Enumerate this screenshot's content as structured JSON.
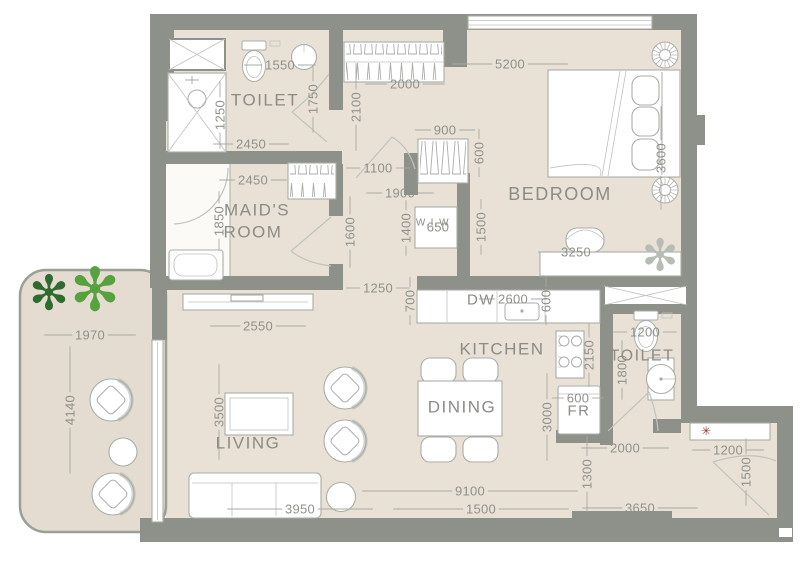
{
  "title": "apartment-floor-plan",
  "rooms": {
    "toilet_top": "TOILET",
    "maids_line1": "MAID'S",
    "maids_line2": "ROOM",
    "wiw": "W.I.W",
    "bedroom": "BEDROOM",
    "kitchen": "KITCHEN",
    "dining": "DINING",
    "living": "LIVING",
    "toilet_entry": "TOILET",
    "dishwasher": "DW",
    "fridge": "FR"
  },
  "dimensions_mm": {
    "d1550": "1550",
    "d2000_closet": "2000",
    "d5200": "5200",
    "d900": "900",
    "d2450_toilet": "2450",
    "d2450_maids": "2450",
    "d1100": "1100",
    "d1900": "1900",
    "d650": "650",
    "d3250": "3250",
    "d1250_hall": "1250",
    "d2600": "2600",
    "d2550": "2550",
    "d1970": "1970",
    "d1200_toilet": "1200",
    "d600_fridge": "600",
    "d2000_entry": "2000",
    "d1200_entry": "1200",
    "d3950": "3950",
    "d9100": "9100",
    "d1500_overall": "1500",
    "d3650": "3650",
    "d1250_shower": "1250",
    "d1750": "1750",
    "d2100": "2100",
    "d600_wardrobe": "600",
    "d3600": "3600",
    "d1850": "1850",
    "d1600": "1600",
    "d1400": "1400",
    "d1500_wiw": "1500",
    "d700": "700",
    "d600_kitchen": "600",
    "d2150": "2150",
    "d1800": "1800",
    "d3000": "3000",
    "d1300": "1300",
    "d1500_entry": "1500",
    "d4140": "4140",
    "d3500": "3500"
  },
  "icons": {
    "plant": "✻",
    "sprinkler": "✳"
  },
  "colors": {
    "wall": "#8d9189",
    "floor": "#e9e1d6",
    "balcony_floor": "#e4dcd0",
    "balcony_edge": "#9aa096",
    "fixture_white": "#ffffff",
    "stroke": "#a9ada7",
    "stroke_light": "#bfc3bc",
    "text": "#8a8c85",
    "dim_text": "#8f918b",
    "dim_line": "#a8aaa3",
    "plant_dark": "#2f6b2f",
    "plant_light": "#57a23e",
    "plant_gray": "#b7bcb4",
    "red": "#9b3a32"
  }
}
